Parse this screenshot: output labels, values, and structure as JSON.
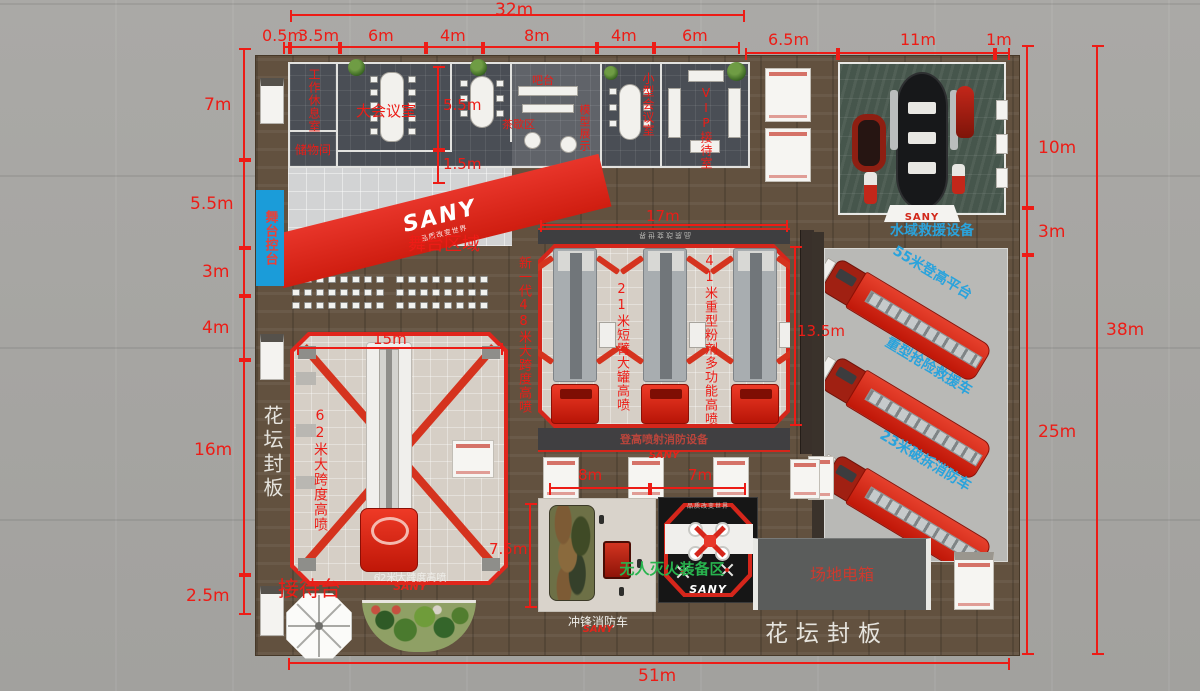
{
  "brand": {
    "name": "SANY",
    "slogan": "品质改变世界"
  },
  "dims": {
    "top_total": "32m",
    "top_segments": [
      "0.5m",
      "3.5m",
      "6m",
      "4m",
      "8m",
      "4m",
      "6m"
    ],
    "top_right_segments": [
      "6.5m",
      "11m",
      "1m"
    ],
    "left_segments": [
      "7m",
      "5.5m",
      "3m",
      "4m",
      "16m",
      "2.5m"
    ],
    "right_segments": [
      "10m",
      "3m",
      "25m"
    ],
    "right_total": "38m",
    "bottom_total": "51m",
    "room_depth": "5.5m",
    "corridor": "1.5m",
    "truck62_width": "15m",
    "center_width": "17m",
    "center_depth": "13.5m",
    "assault_depth": "7.5m",
    "counter_left": "8m",
    "counter_right": "7m"
  },
  "rooms": {
    "work_lounge": "工作休息室",
    "storage": "储物间",
    "main_meeting": "大会议室",
    "bar": "吧台",
    "tea_break": "茶歇区",
    "model_display": "模型展示",
    "small_meeting": "小型会议室",
    "vip_reception": "VIP接待室"
  },
  "stage": {
    "control": "舞台控台",
    "area": "舞台区域"
  },
  "zones": {
    "span62": "62米大跨度高喷",
    "span62_caption": "62米大跨度高喷",
    "reception": "接待台",
    "newgen48": "新一代48米大跨度高喷",
    "boom21": "21米短臂大罐高喷",
    "powder41": "41米重型粉剂多功能高喷",
    "aerial_caption": "登高喷射消防设备",
    "water": "水域救援设备",
    "platform55": "55米登高平台",
    "rescue_heavy": "重型抢险救援车",
    "demolition23": "23米破拆消防车",
    "unmanned": "无人灭火装备区",
    "assault": "冲锋消防车",
    "powerbox": "场地电箱",
    "flowerbed": "花坛封板"
  },
  "colors": {
    "dimension_red": "#ed1c16",
    "label_blue": "#2aa3dc",
    "label_green": "#28b44e",
    "stage_blue": "#1b9cd9",
    "truck_red": "#dd2d18",
    "wood": "#62513f"
  }
}
